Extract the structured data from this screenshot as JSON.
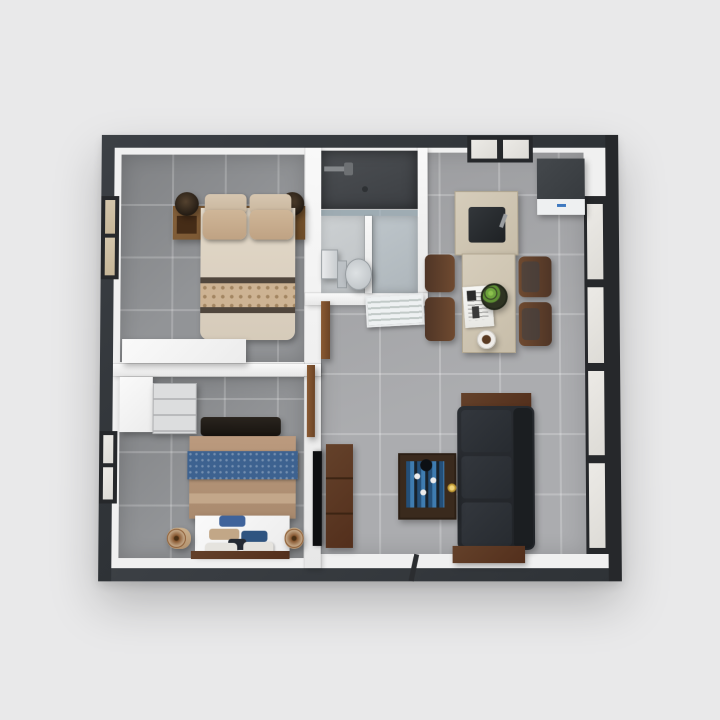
{
  "scene": {
    "kind": "3d-floor-plan-render",
    "description": "Top-down 3D render of a small one-storey apartment floor plan on a light gray background",
    "background_color": "#e9e9ea",
    "palette": {
      "outer_wall": "#34383d",
      "interior_wall": "#f1f1f1",
      "bedroom_floor_tile": "#8e9093",
      "living_kitchen_floor_tile": "#a7a8ab",
      "shower_floor": "#45484c",
      "bathroom_floor": "#c6cacc",
      "window_frame": "#26282b",
      "glass_pane": "#e7e5e1",
      "wood_brown": "#7a5631",
      "dark_wood": "#5d3a23",
      "counter_beige": "#cfc6b4",
      "bed1_duvet_cream": "#dcd2c2",
      "bed2_duvet_tan": "#b29176",
      "accent_blue": "#3d6290",
      "sofa_charcoal": "#26292d",
      "tray_gold": "#c9a23a",
      "fruit_green": "#6da33c"
    },
    "rooms": [
      {
        "name": "bedroom-1",
        "location": "top-left",
        "floor": "gray ceramic tile",
        "contents": [
          "double bed with cream duvet and patterned band",
          "wood headboard shelf with integrated nightstands",
          "two dark table lamps",
          "four beige pillows",
          "white desk against south wall",
          "curtained window on left wall"
        ]
      },
      {
        "name": "bathroom",
        "location": "top-center",
        "contents": [
          "dark tiled walk-in shower with shower head",
          "glass partition",
          "wall-hung sink",
          "toilet",
          "glass stall divider",
          "white louvered door"
        ]
      },
      {
        "name": "kitchen",
        "location": "top-right",
        "contents": [
          "refrigerator",
          "island with dark sink and faucet",
          "bar counter",
          "four brown dining chairs",
          "bowl of green fruit",
          "newspaper",
          "cup of coffee",
          "window in top wall"
        ]
      },
      {
        "name": "bedroom-2",
        "location": "bottom-left",
        "contents": [
          "double bed with tan duvet and blue runner",
          "dark headboard",
          "white foot platform with folded blue and white linens",
          "two rolled bolster cushions on floor",
          "white wardrobe",
          "gray dresser",
          "window on left wall"
        ]
      },
      {
        "name": "living-area",
        "location": "bottom-right",
        "contents": [
          "charcoal three-seat sofa with wood trim",
          "wall-mounted TV",
          "dark wood TV console",
          "wood-framed tray coffee table with blue pattern and gold ornament",
          "floor-to-ceiling window wall on right",
          "entry threshold in bottom wall"
        ]
      }
    ]
  }
}
